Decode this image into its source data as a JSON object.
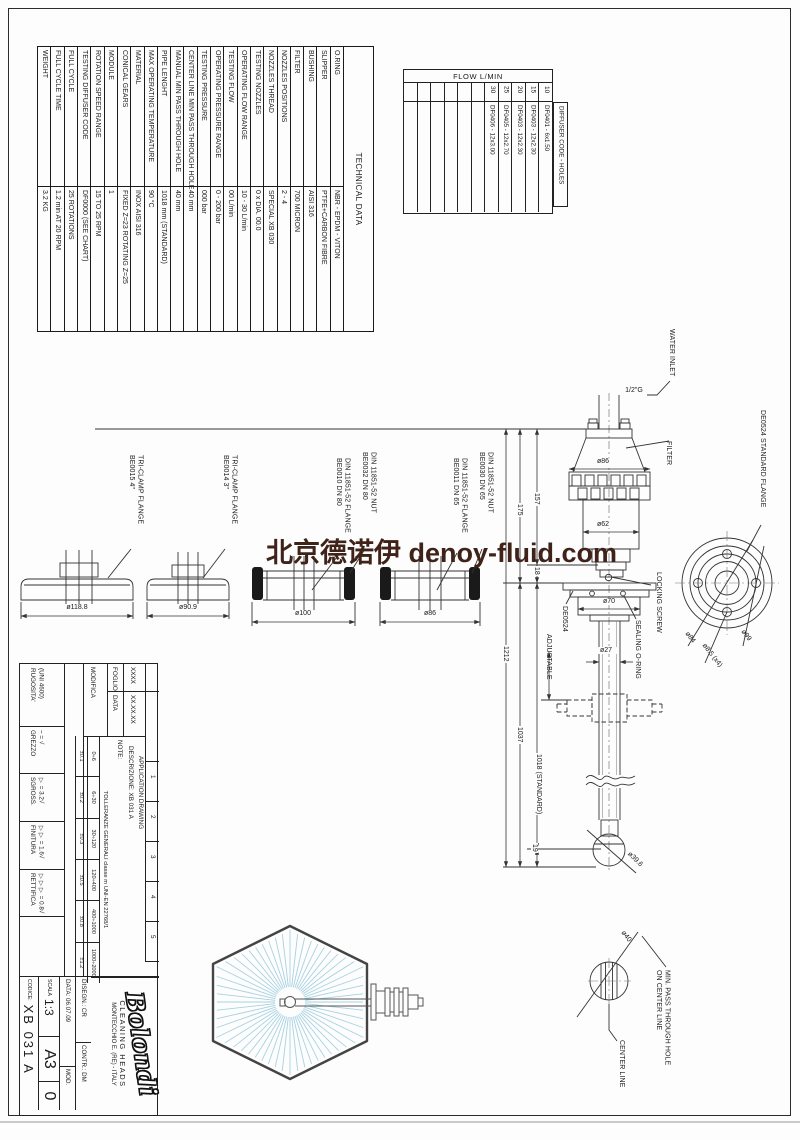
{
  "watermark": {
    "text": "北京德诺伊 denoy-fluid.com",
    "color": "#3f2218"
  },
  "technical_table": {
    "title": "TECHNICAL DATA",
    "rows": [
      {
        "label": "O.RING",
        "value": "NBR - EPDM - VITON"
      },
      {
        "label": "SLIPPER",
        "value": "PTFE+CARBON FIBRE"
      },
      {
        "label": "BUSHING",
        "value": "AISI 316"
      },
      {
        "label": "FILTER",
        "value": "700 MICRON"
      },
      {
        "label": "NOZZLES POSITIONS",
        "value": "2 - 4"
      },
      {
        "label": "NOZZLES THREAD",
        "value": "SPECIAL XB 030"
      },
      {
        "label": "TESTING NOZZLES",
        "value": "0 x DIA. 00.0"
      },
      {
        "label": "OPERATING FLOW RANGE",
        "value": "10 - 30 L/min"
      },
      {
        "label": "TESTING FLOW",
        "value": "00 L/min"
      },
      {
        "label": "OPERATING PRESSURE RANGE",
        "value": "0 - 200 bar"
      },
      {
        "label": "TESTING PRESSURE",
        "value": "000 bar"
      },
      {
        "label": "CENTER LINE MIN PASS THROUGH HOLE",
        "value": "40 mm"
      },
      {
        "label": "MANUAL MIN PASS THROUGH HOLE",
        "value": "40 mm"
      },
      {
        "label": "PIPE LENGHT",
        "value": "1018 mm (STANDARD)"
      },
      {
        "label": "MAX OPERATING TEMPERATURE",
        "value": "90 °C"
      },
      {
        "label": "MATERIAL",
        "value": "INOX AISI 316"
      },
      {
        "label": "CONICAL GEARS",
        "value": "FIXED Z=23 ROTATING Z=25"
      },
      {
        "label": "MODULE",
        "value": "1"
      },
      {
        "label": "ROTATION SPEED RANGE",
        "value": "15 TO 25 RPM"
      },
      {
        "label": "TESTING DIFFUSER CODE",
        "value": "DF0000 (SEE CHART)"
      },
      {
        "label": "FULL CYCLE",
        "value": "25 ROTATIONS"
      },
      {
        "label": "FULL CYCLE TIME",
        "value": "1.2 min AT 20 RPM"
      },
      {
        "label": "WEIGHT",
        "value": "3.2 KG"
      }
    ]
  },
  "flow_table": {
    "title": "FLOW L/MIN",
    "side_header": "DIFFUSER CODE - HOLES",
    "columns": [
      {
        "flow": "30",
        "code": "DF0406 - 12x3.00"
      },
      {
        "flow": "25",
        "code": "DF0405 - 12x2.70"
      },
      {
        "flow": "20",
        "code": "DF0403 - 12x2.30"
      },
      {
        "flow": "15",
        "code": "DF0403 - 12x2.30"
      },
      {
        "flow": "10",
        "code": "DF0401 - 6x1.50"
      }
    ]
  },
  "flanges": {
    "tri4": {
      "line1": "BE0015 4\"",
      "line2": "TRI-CLAMP FLANGE",
      "dim": "ø118.8"
    },
    "tri3": {
      "line1": "BE0014 3\"",
      "line2": "TRI-CLAMP FLANGE",
      "dim": "ø90.9"
    },
    "din80_flange": {
      "line1": "BE0010 DN 80",
      "line2": "DIN 11851-52 FLANGE",
      "dim": "ø100"
    },
    "din80_nut": {
      "line1": "BE0032 DN 80",
      "line2": "DIN 11851-52 NUT"
    },
    "din65_flange": {
      "line1": "BE0011 DN 65",
      "line2": "DIN 11851-52 FLANGE",
      "dim": "ø86"
    },
    "din65_nut": {
      "line1": "BE0030 DN 65",
      "line2": "DIN 11851-52 NUT"
    }
  },
  "assembly": {
    "water_inlet": "WATER INLET",
    "inlet_thread": "1/2\"G",
    "filter": "FILTER",
    "locking_screw": "LOCKING SCREW",
    "sealing_oring": "SEALING O-RING",
    "de0524": "DE0524",
    "adjustable": "ADJUSTABLE",
    "standard_flange": "DE0524 STANDARD FLANGE",
    "dims": {
      "d86": "ø86",
      "d62": "ø62",
      "d70": "ø70",
      "d27": "ø27",
      "d39": "ø39.6",
      "v157": "157",
      "v175": "175",
      "v18": "18",
      "v19": "19",
      "v1212": "1212",
      "v1037": "1037",
      "v1018": "1018 (STANDARD)",
      "d84": "ø84",
      "d85": "ø8.5 (x4)",
      "d99": "ø99"
    }
  },
  "detail": {
    "dim": "ø40",
    "line1": "MIN. PASS THROUGH HOLE",
    "line2": "ON CENTER LINE",
    "center": "CENTER LINE"
  },
  "title_block": {
    "roughness": {
      "h1": "RUGOSITA'",
      "h2": "(UNI 4600)",
      "rows": [
        {
          "name": "GREZZO",
          "value": "~ = √"
        },
        {
          "name": "SGROSS.",
          "value": "▽ = 3.2√"
        },
        {
          "name": "FINITURA",
          "value": "▽▽ = 1.6√"
        },
        {
          "name": "RETTIFICA",
          "value": "▽▽▽ = 0.8√"
        }
      ]
    },
    "revision": {
      "modifica": "MODIFICA",
      "foglio_label": "FOGLIO",
      "foglio": "XXXX",
      "data_label": "DATA",
      "data": "XX.XX.XX",
      "cols": [
        "1",
        "2",
        "3",
        "4",
        "5"
      ]
    },
    "tolerances": {
      "header": "TOLLERANZE GENERALI classe m UNI-EN 22768/1",
      "ranges": [
        "0÷6",
        "6÷30",
        "30÷120",
        "120÷400",
        "400÷1000",
        "1000÷2000"
      ],
      "values": [
        "±0.1",
        "±0.2",
        "±0.3",
        "±0.5",
        "±0.8",
        "±1.2"
      ]
    },
    "note": "NOTE:",
    "descr1": "DESCRIZIONE:  XB 031 A",
    "descr2": "APPLICATION DRAWING",
    "company": {
      "logo": "Bolondi",
      "tagline": "CLEANING HEADS",
      "address": "MONTECCHIO E. (RE) - ITALY"
    },
    "info": {
      "disegn": "DISEGN.: CR",
      "contr": "CONTR.: DM",
      "data": "DATA:  06.07.09",
      "mod": "MOD.",
      "scala_label": "SCALA",
      "scala": "1:3",
      "format": "A3",
      "rev": "0",
      "codice_label": "CODICE:",
      "codice": "XB 031 A"
    }
  }
}
